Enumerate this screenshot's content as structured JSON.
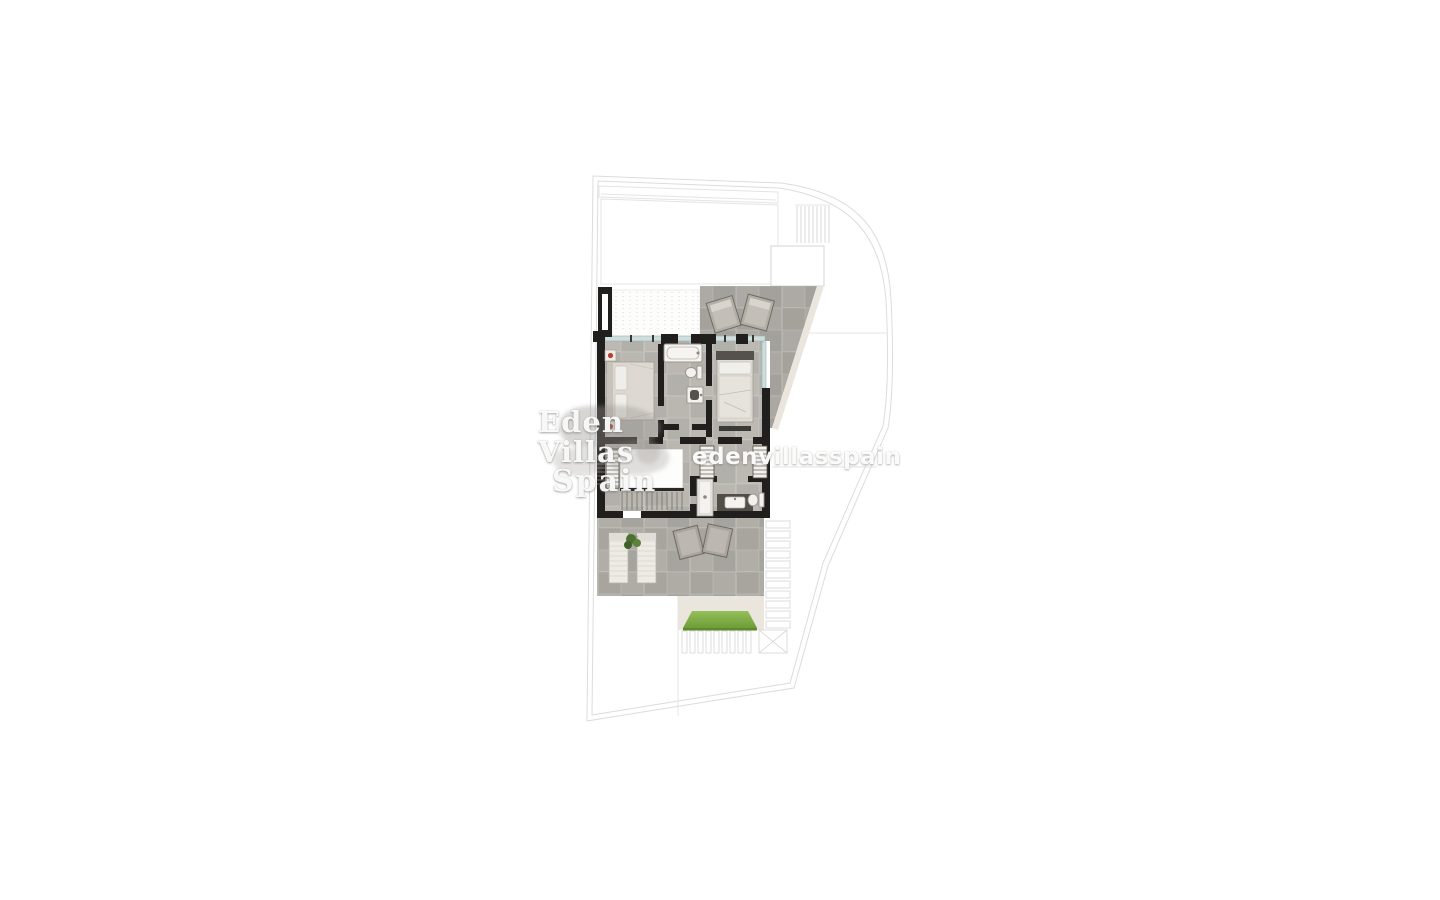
{
  "figure": {
    "type": "floor-plan",
    "description": "Upper floor plan of a villa inside a curved plot boundary: two bedrooms, two bathrooms, dressing area with wardrobes, central staircase, upper terrace with two loungers, lower terrace with sun beds and chairs, side steps, pergola slats and a grass patch"
  },
  "watermarks": {
    "logo": {
      "line1": "Eden Villas",
      "line2": "Spain"
    },
    "center": "edenvillasspain"
  },
  "colors": {
    "background": "#ffffff",
    "plot_line": "#dcdcdc",
    "faint_line": "#e4e4e4",
    "wall": "#211f1d",
    "tile_base": "#b1aea8",
    "glass": "#cddedd",
    "deck_beige": "#eae6dd",
    "grass_light": "#93c05a",
    "grass_dark": "#6f9c38",
    "accent_red": "#b5432e",
    "plant_green": "#4c7030",
    "watermark_white": "#ffffff"
  }
}
